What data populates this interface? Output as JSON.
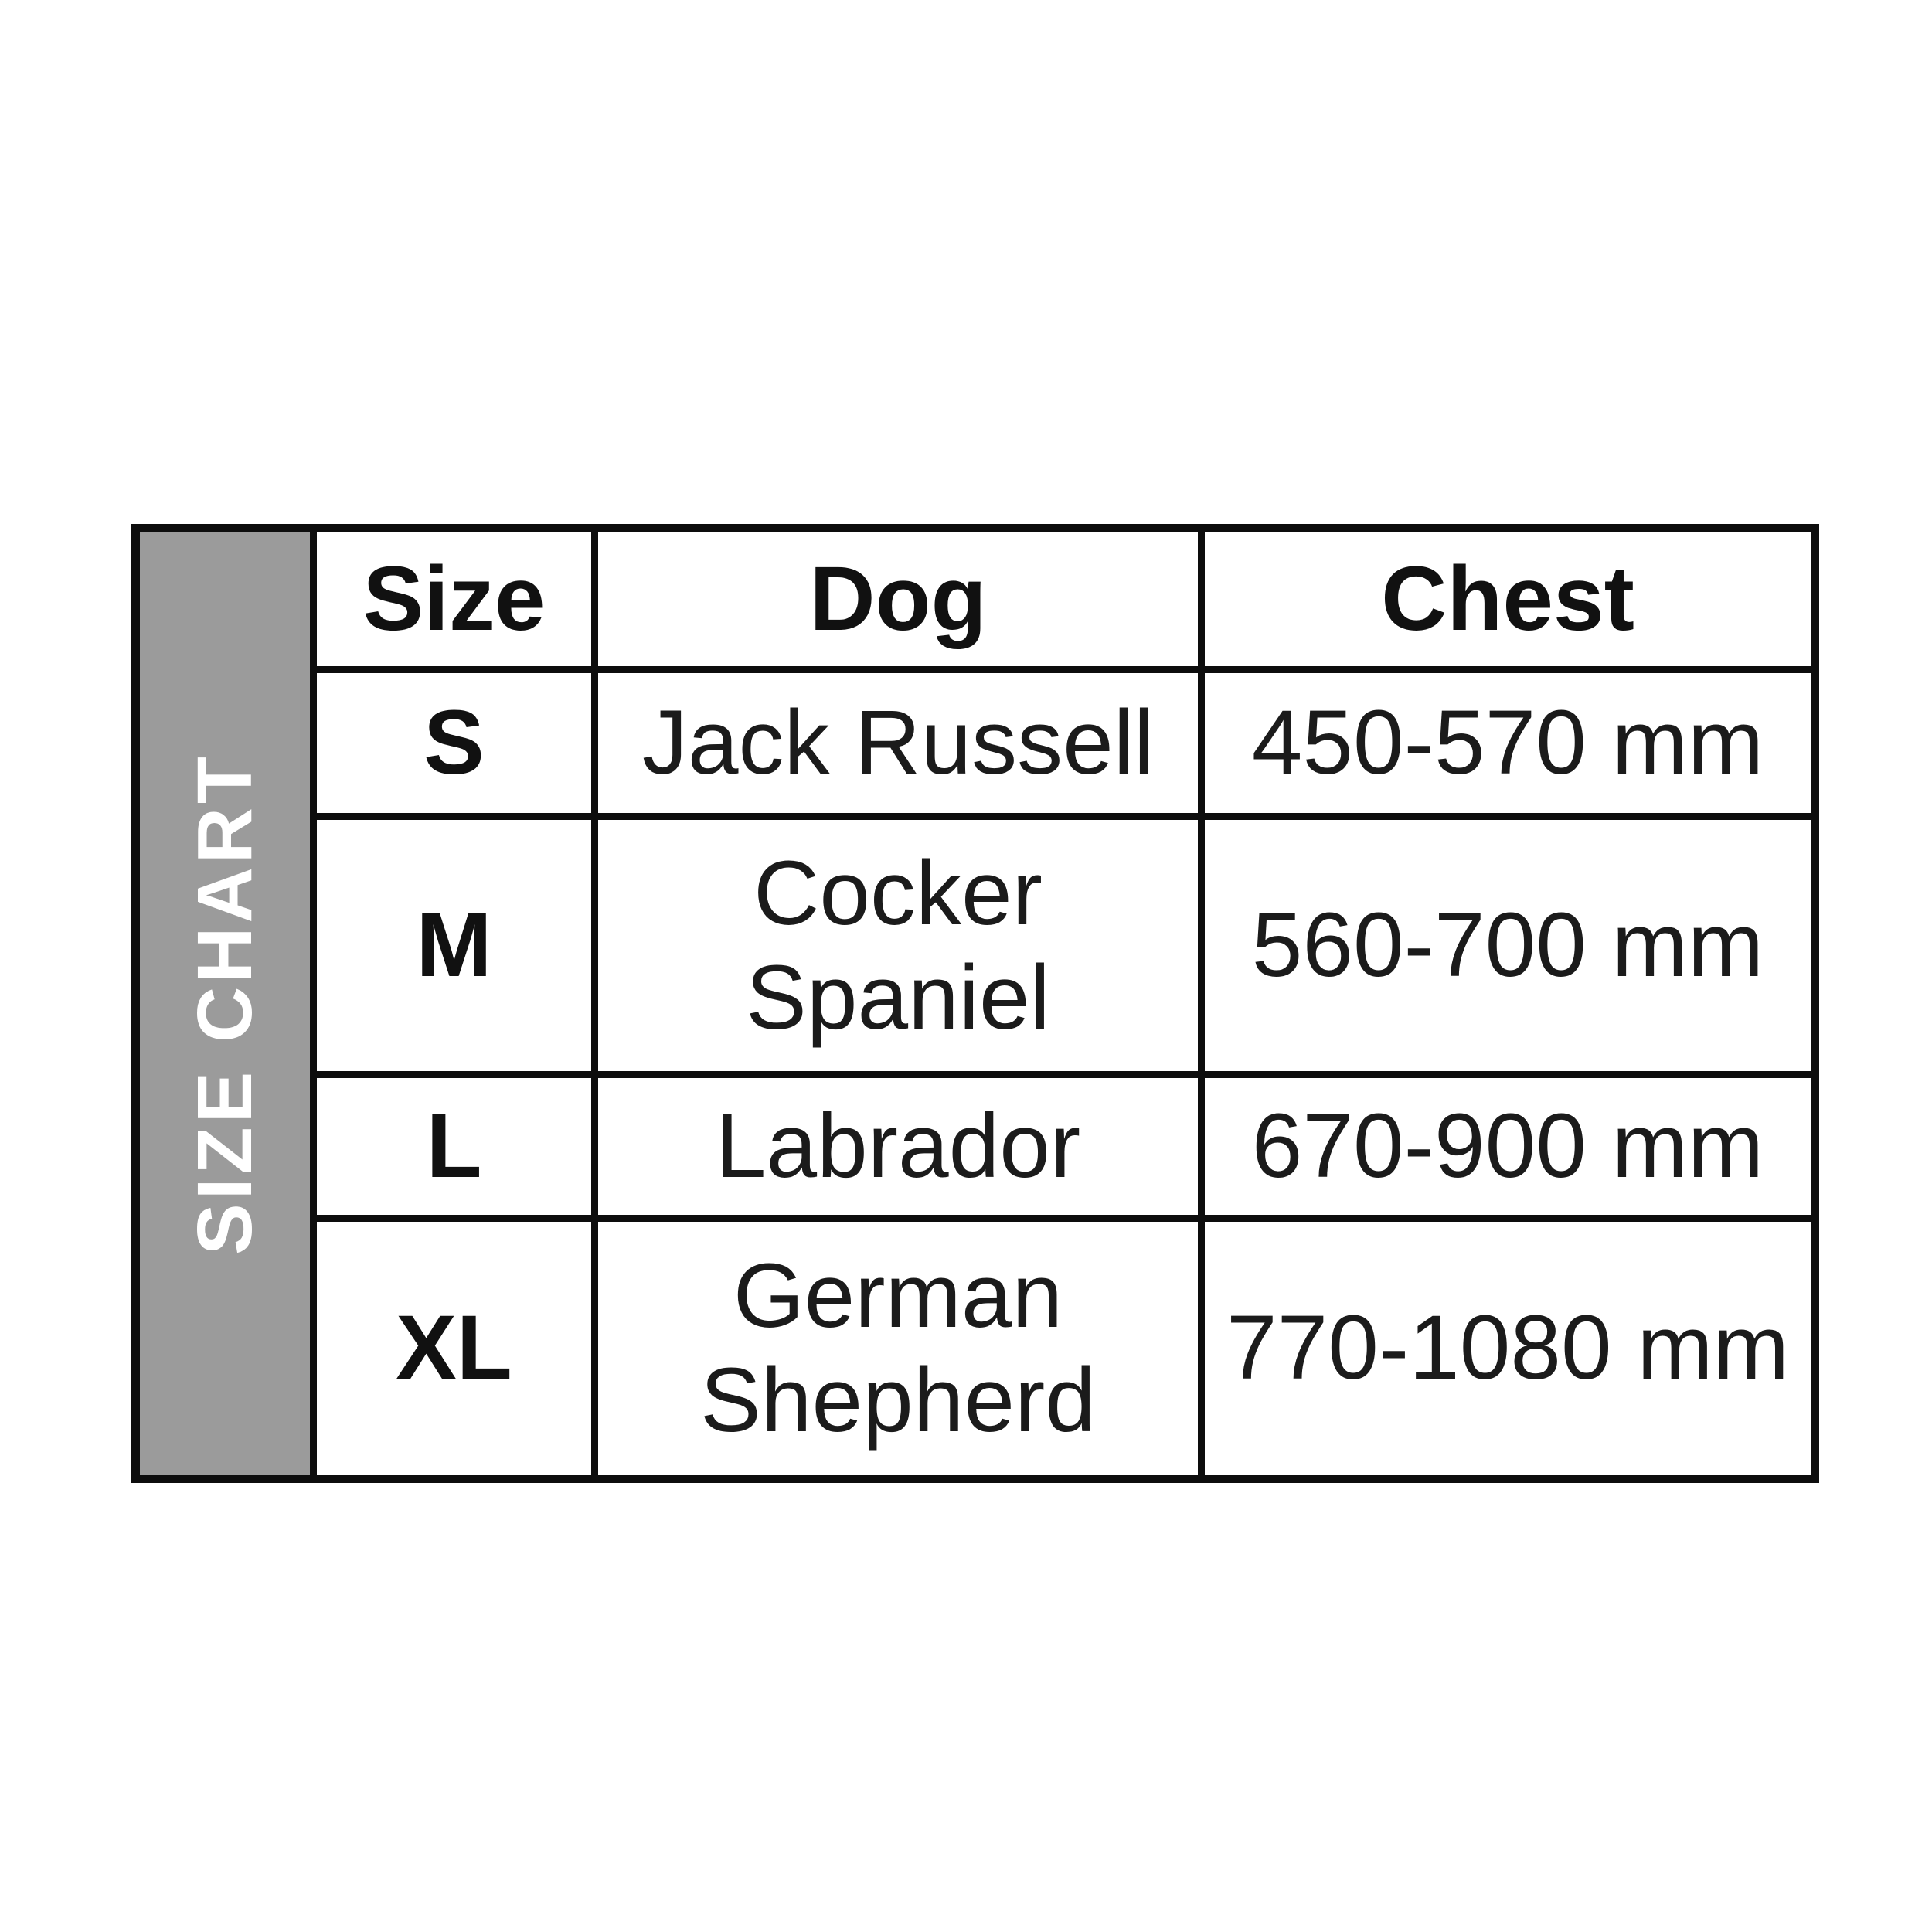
{
  "sidebar": {
    "label": "SIZE CHART"
  },
  "chart_data": {
    "type": "table",
    "title": "SIZE CHART",
    "columns": [
      "Size",
      "Dog",
      "Chest"
    ],
    "rows": [
      {
        "size": "S",
        "dog": "Jack Russell",
        "chest": "450-570 mm"
      },
      {
        "size": "M",
        "dog": "Cocker\nSpaniel",
        "chest": "560-700 mm"
      },
      {
        "size": "L",
        "dog": "Labrador",
        "chest": "670-900 mm"
      },
      {
        "size": "XL",
        "dog": "German\nShepherd",
        "chest": "770-1080 mm"
      }
    ]
  },
  "colors": {
    "background": "#ffffff",
    "border": "#0d0d0d",
    "sidebar_bg": "#9b9b9b",
    "sidebar_text": "#ffffff",
    "text": "#1b1b1b"
  }
}
